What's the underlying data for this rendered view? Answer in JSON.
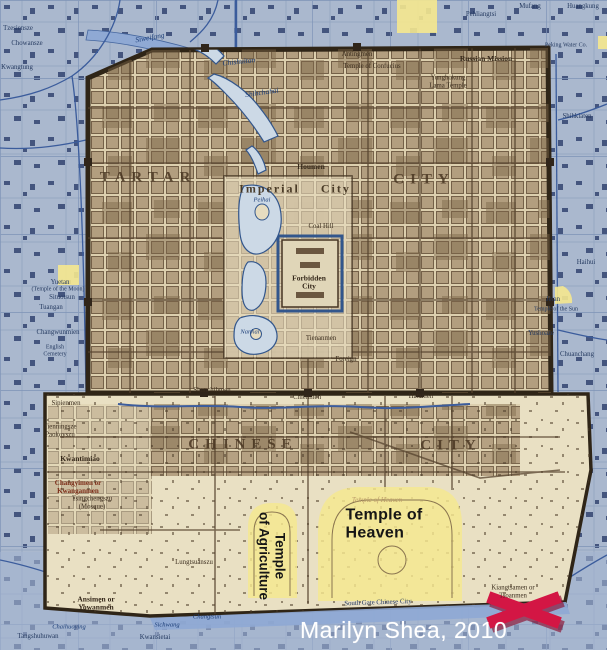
{
  "attribution": "Marilyn Shea, 2010",
  "colors": {
    "modern_map_blue": "#a9b7cd",
    "old_map_sepia": "#dccfae",
    "wall_dark_brown": "#2f2517",
    "water_blue": "#ccd9e6",
    "highlight_yellow": "#f5e88f",
    "marker_red": "#d31644",
    "attribution_white": "#ffffff"
  },
  "marker": {
    "type": "red-x",
    "x": 524,
    "y": 610
  },
  "highlighted_sites": [
    "Temple of Heaven",
    "Temple of Agriculture"
  ],
  "labels": [
    {
      "text": "TARTAR",
      "x": 148,
      "y": 178,
      "cls": "big",
      "name": "label-tartar-city"
    },
    {
      "text": "CITY",
      "x": 424,
      "y": 180,
      "cls": "big",
      "name": "label-tartar-city-2"
    },
    {
      "text": "CHINESE",
      "x": 243,
      "y": 445,
      "cls": "big",
      "name": "label-chinese-city"
    },
    {
      "text": "CITY",
      "x": 451,
      "y": 446,
      "cls": "big",
      "name": "label-chinese-city-2"
    },
    {
      "text": "Imperial City",
      "x": 295,
      "y": 189,
      "cls": "imp",
      "name": "label-imperial-city"
    },
    {
      "text": "Forbidden\nCity",
      "x": 309,
      "y": 283,
      "cls": "smdk",
      "name": "label-forbidden-city"
    },
    {
      "text": "Coal Hill",
      "x": 321,
      "y": 227,
      "cls": "gate"
    },
    {
      "text": "Houmen",
      "x": 311,
      "y": 167,
      "cls": "smdk"
    },
    {
      "text": "Tienanmen",
      "x": 321,
      "y": 339,
      "cls": "gate"
    },
    {
      "text": "Foreign",
      "x": 346,
      "y": 360,
      "cls": "gate"
    },
    {
      "text": "Antingmen",
      "x": 357,
      "y": 55,
      "cls": "gate"
    },
    {
      "text": "Temple of Confucius",
      "x": 372,
      "y": 67,
      "cls": "gate"
    },
    {
      "text": "Yunghokung\nLama Temple",
      "x": 448,
      "y": 82,
      "cls": "gate"
    },
    {
      "text": "Russian Mission",
      "x": 486,
      "y": 59,
      "cls": "smdk"
    },
    {
      "text": "Chienmen",
      "x": 307,
      "y": 398,
      "cls": "gate"
    },
    {
      "text": "Hatamen",
      "x": 421,
      "y": 397,
      "cls": "gate"
    },
    {
      "text": "Shunchihmen",
      "x": 212,
      "y": 391,
      "cls": "gate"
    },
    {
      "text": "Sipienmen",
      "x": 66,
      "y": 404,
      "cls": "gate"
    },
    {
      "text": "Kwantimiao",
      "x": 80,
      "y": 459,
      "cls": "smdk"
    },
    {
      "text": "Changyimen or\nKwanganmen",
      "x": 78,
      "y": 488,
      "cls": "red"
    },
    {
      "text": "Tsingchengszu\n(Mosque)",
      "x": 92,
      "y": 503,
      "cls": "gate"
    },
    {
      "text": "Tienningsze\nPaokovszu",
      "x": 60,
      "y": 431,
      "cls": "gate"
    },
    {
      "text": "Ansimen or\nYowanmen",
      "x": 96,
      "y": 604,
      "cls": "smdk"
    },
    {
      "text": "Lungtsuanszu",
      "x": 194,
      "y": 563,
      "cls": "gate"
    },
    {
      "text": "Kiangtsamen or\nTsoanmen",
      "x": 513,
      "y": 592,
      "cls": "gate"
    },
    {
      "text": "South Gate Chinese City",
      "x": 378,
      "y": 603,
      "cls": "smnv",
      "rot": -2
    },
    {
      "text": "Temple of Heaven",
      "x": 377,
      "y": 501,
      "cls": "faint",
      "name": "label-temple-of-heaven-faint"
    },
    {
      "text": "Siweifang",
      "x": 150,
      "y": 38,
      "cls": "smbl",
      "rot": -10
    },
    {
      "text": "Chishuitan",
      "x": 239,
      "y": 62,
      "cls": "smbl",
      "rot": -6
    },
    {
      "text": "Shihchahai",
      "x": 262,
      "y": 93,
      "cls": "smbl",
      "rot": -8
    },
    {
      "text": "Peihai",
      "x": 262,
      "y": 200,
      "cls": "smbl f65"
    },
    {
      "text": "Nanhai",
      "x": 250,
      "y": 332,
      "cls": "smbl f65"
    },
    {
      "text": "Kwangtung",
      "x": 17,
      "y": 68,
      "cls": "smnv"
    },
    {
      "text": "Chowansze",
      "x": 27,
      "y": 44,
      "cls": "smnv"
    },
    {
      "text": "Tzesiensze",
      "x": 18,
      "y": 29,
      "cls": "smnv"
    },
    {
      "text": "Pehliangtsi",
      "x": 481,
      "y": 15,
      "cls": "smnv"
    },
    {
      "text": "Mufang",
      "x": 530,
      "y": 7,
      "cls": "smnv"
    },
    {
      "text": "Huangkung",
      "x": 583,
      "y": 7,
      "cls": "smnv"
    },
    {
      "text": "Peking Water Co.",
      "x": 566,
      "y": 46,
      "cls": "smnv f6"
    },
    {
      "text": "Shihkiaten",
      "x": 577,
      "y": 117,
      "cls": "smnv"
    },
    {
      "text": "Haihui",
      "x": 586,
      "y": 263,
      "cls": "smnv"
    },
    {
      "text": "Jetan",
      "x": 553,
      "y": 300,
      "cls": "smnv"
    },
    {
      "text": "Temple of the Sun",
      "x": 556,
      "y": 310,
      "cls": "smnv f6"
    },
    {
      "text": "Yushoaze",
      "x": 541,
      "y": 334,
      "cls": "smnv"
    },
    {
      "text": "Chuanchang",
      "x": 577,
      "y": 355,
      "cls": "smnv"
    },
    {
      "text": "Yuetan",
      "x": 60,
      "y": 283,
      "cls": "smnv"
    },
    {
      "text": "(Temple of the Moon)",
      "x": 58,
      "y": 290,
      "cls": "smnv f6"
    },
    {
      "text": "Situotsun",
      "x": 62,
      "y": 298,
      "cls": "smnv"
    },
    {
      "text": "Tuangan",
      "x": 51,
      "y": 308,
      "cls": "smnv"
    },
    {
      "text": "Changwunmien",
      "x": 58,
      "y": 333,
      "cls": "smnv"
    },
    {
      "text": "English\nCemetery",
      "x": 55,
      "y": 351,
      "cls": "smnv f6"
    },
    {
      "text": "Sichwang",
      "x": 167,
      "y": 625,
      "cls": "smbl f65"
    },
    {
      "text": "Changtsun",
      "x": 207,
      "y": 617,
      "cls": "smbl f65"
    },
    {
      "text": "Kwansietai",
      "x": 155,
      "y": 638,
      "cls": "smnv"
    },
    {
      "text": "Chaihuoying",
      "x": 69,
      "y": 627,
      "cls": "smbl f65"
    },
    {
      "text": "Tangshuhuwan",
      "x": 38,
      "y": 637,
      "cls": "smnv"
    },
    {
      "text": "Temple of\nHeaven",
      "x": 384,
      "y": 525,
      "cls": "modern la",
      "name": "label-temple-of-heaven"
    },
    {
      "text": "Temple\nof Agriculture",
      "x": 272,
      "y": 556,
      "cls": "modern2",
      "rot": 90,
      "name": "label-temple-of-agriculture"
    }
  ]
}
